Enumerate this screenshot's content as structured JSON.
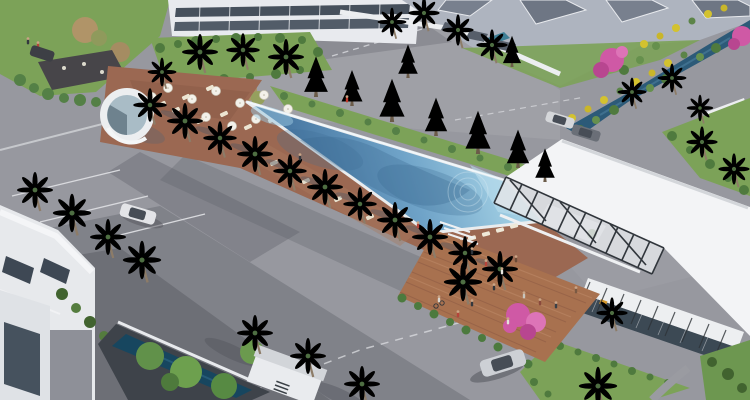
{
  "scene": {
    "description": "Aerial 3D architectural rendering of a residential resort community: a large rectangular swimming pool lined with palm trees and sun loungers, a white flat-roof clubhouse with dark pergola beams, a wooden plaza deck with people, terracotta pool deck with umbrellas, gray roads with parked cars, a landscaped canal with pink bougainvillea and yellow flowers, villas and apartment buildings",
    "style": "daytime photorealistic render, oblique top-down view",
    "weather": "sunny, hard shadows from upper-left"
  },
  "palette": {
    "road": "#97989f",
    "road_shadow": "#63646c",
    "pool_light": "#a6d3e6",
    "pool_deep": "#3f6e9a",
    "coping": "#e9ecee",
    "deck": "#9b6852",
    "plaza": "#a8714f",
    "roof": "#f3f4f6",
    "lawn": "#7ca258",
    "hedge": "#4f7a3e",
    "conifer": "#3c654a",
    "palm": "#6a935a",
    "canal": "#2c5a78",
    "bougainvillea": "#cf59a5",
    "yellow_flower": "#d3c22f",
    "villa_roof": "#78808e",
    "wall_white": "#eceef0",
    "window_glass": "#3c4954"
  },
  "objects": {
    "pool": {
      "label": "main community swimming pool"
    },
    "clubhouse": {
      "label": "white clubhouse with pergola and glass facade"
    },
    "plaza": {
      "label": "wooden deck plaza with visitors"
    },
    "canal": {
      "label": "landscaped water canal"
    },
    "fountain": {
      "label": "round splash pad water feature"
    },
    "counts": {
      "palm_trees": 30,
      "conifer_trees": 9,
      "cars": 5,
      "people": 16,
      "umbrellas": 10,
      "sun_loungers": 20,
      "buildings": 7
    }
  }
}
